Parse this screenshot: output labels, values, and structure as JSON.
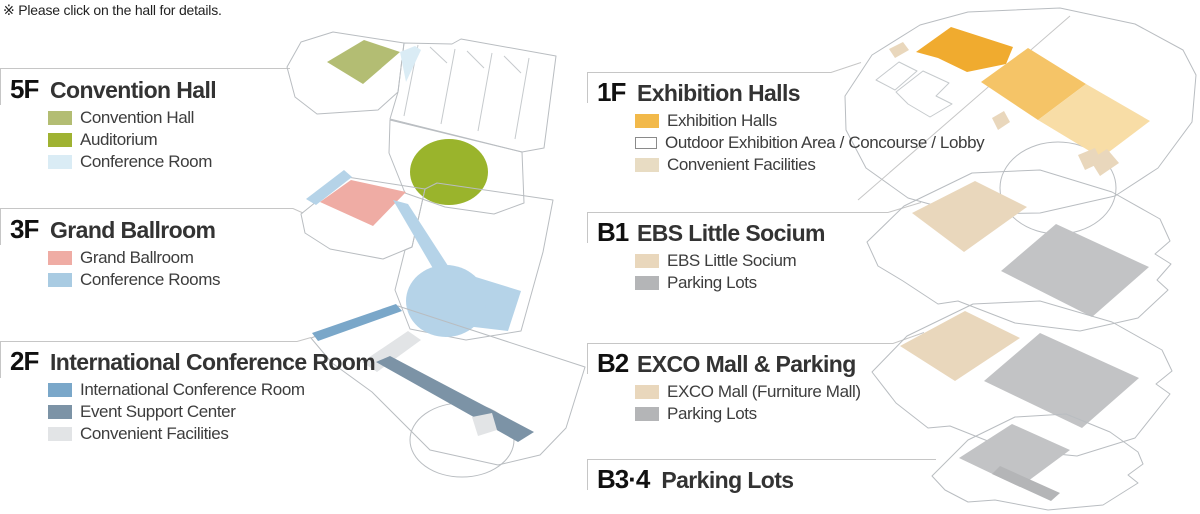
{
  "note": "※ Please click on the hall for details.",
  "colors": {
    "outline": "#b9bdc1",
    "outline_light": "#c6cacd",
    "leader": "#c6c6c6",
    "sage": "#b3bd73",
    "olive": "#9ab42c",
    "pale_blue": "#daecf5",
    "pink": "#efaca4",
    "light_blue": "#b5d3e8",
    "mid_blue": "#7aa7c9",
    "slate": "#7c93a6",
    "light_gray": "#e2e4e6",
    "orange_dark": "#f0ab2f",
    "orange_mid": "#f5c467",
    "orange_light": "#f8dda6",
    "tan": "#e9d7bc",
    "gray": "#c2c3c5",
    "gray_dark": "#b4b5b7",
    "white": "#ffffff",
    "outdoor_border": "#8a8a8a"
  },
  "sections": [
    {
      "floor": "5F",
      "title": "Convention Hall",
      "legend": [
        {
          "label": "Convention Hall",
          "fill": "#b3bd73"
        },
        {
          "label": "Auditorium",
          "fill": "#9fb232"
        },
        {
          "label": "Conference Room",
          "fill": "#daecf5"
        }
      ]
    },
    {
      "floor": "3F",
      "title": "Grand Ballroom",
      "legend": [
        {
          "label": "Grand Ballroom",
          "fill": "#efaca4"
        },
        {
          "label": "Conference Rooms",
          "fill": "#a9cbe2"
        }
      ]
    },
    {
      "floor": "2F",
      "title": "International Conference Room",
      "legend": [
        {
          "label": "International Conference Room",
          "fill": "#7aa7c9"
        },
        {
          "label": "Event Support Center",
          "fill": "#7c93a6"
        },
        {
          "label": "Convenient Facilities",
          "fill": "#e2e4e6"
        }
      ]
    },
    {
      "floor": "1F",
      "title": "Exhibition Halls",
      "legend": [
        {
          "label": "Exhibition Halls",
          "fill": "#f2b94a"
        },
        {
          "label": "Outdoor Exhibition Area / Concourse / Lobby",
          "fill": "#ffffff",
          "border": "#8a8a8a"
        },
        {
          "label": "Convenient Facilities",
          "fill": "#e8dcc3"
        }
      ]
    },
    {
      "floor": "B1",
      "title": "EBS Little Socium",
      "legend": [
        {
          "label": "EBS Little Socium",
          "fill": "#e9d7bc"
        },
        {
          "label": "Parking Lots",
          "fill": "#b4b5b7"
        }
      ]
    },
    {
      "floor": "B2",
      "title": "EXCO Mall & Parking",
      "legend": [
        {
          "label": "EXCO Mall (Furniture Mall)",
          "fill": "#e9d7bc"
        },
        {
          "label": "Parking Lots",
          "fill": "#b4b5b7"
        }
      ]
    },
    {
      "floor": "B3·4",
      "title": "Parking Lots",
      "legend": []
    }
  ]
}
